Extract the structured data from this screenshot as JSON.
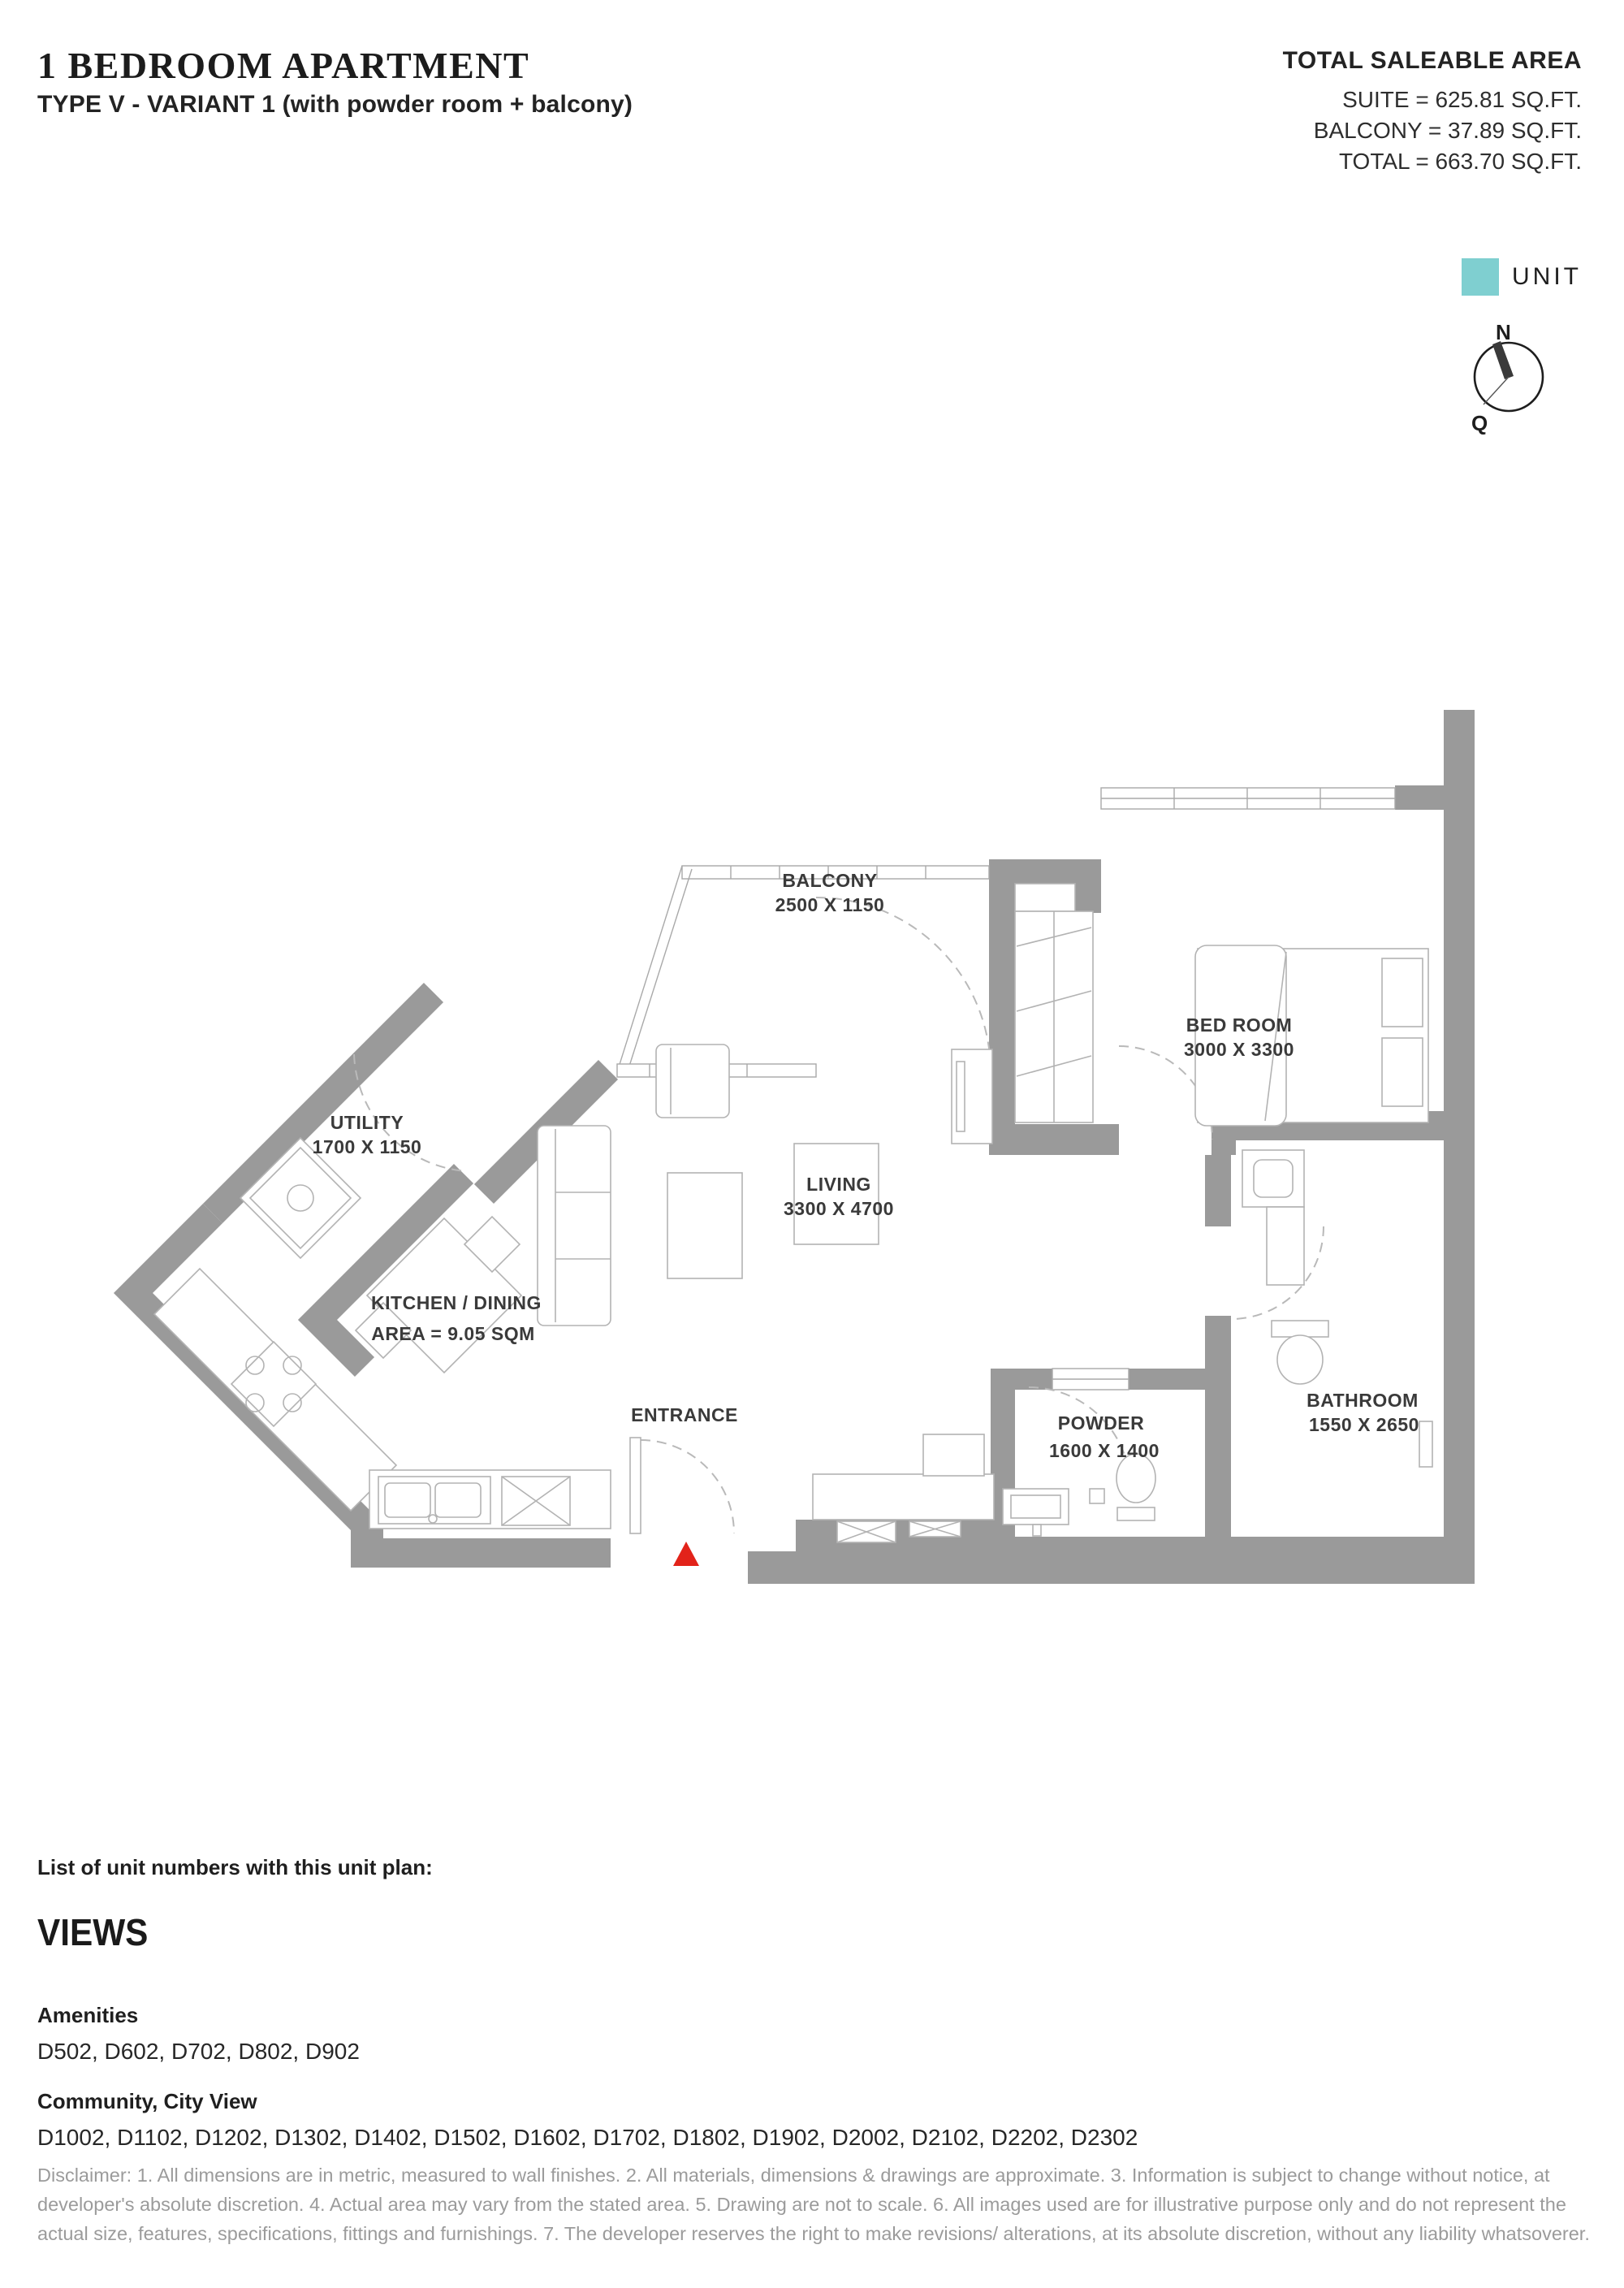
{
  "header": {
    "title": "1 BEDROOM APARTMENT",
    "subtitle": "TYPE V - VARIANT 1 (with powder room + balcony)",
    "area": {
      "heading": "TOTAL SALEABLE AREA",
      "suite": "SUITE =  625.81 SQ.FT.",
      "balcony": "BALCONY = 37.89 SQ.FT.",
      "total": "TOTAL = 663.70 SQ.FT."
    }
  },
  "legend": {
    "unit_label": "UNIT",
    "unit_color": "#7fcfd0"
  },
  "compass": {
    "north_label": "N",
    "q_label": "Q"
  },
  "plan": {
    "wall_color": "#9a9a9a",
    "entrance_marker_color": "#e2231a",
    "balcony": {
      "name": "BALCONY",
      "dim": "2500 X 1150"
    },
    "bedroom": {
      "name": "BED ROOM",
      "dim": "3000 X 3300"
    },
    "utility": {
      "name": "UTILITY",
      "dim": "1700 X 1150"
    },
    "living": {
      "name": "LIVING",
      "dim": "3300 X 4700"
    },
    "kitchen": {
      "name": "KITCHEN / DINING",
      "dim": "AREA = 9.05 SQM"
    },
    "entrance": {
      "name": "ENTRANCE"
    },
    "powder": {
      "name": "POWDER",
      "dim": "1600 X 1400"
    },
    "bathroom": {
      "name": "BATHROOM",
      "dim": "1550 X 2650"
    }
  },
  "footer": {
    "list_heading": "List of unit numbers with this unit plan:",
    "views_heading": "VIEWS",
    "sections": [
      {
        "title": "Amenities",
        "units": "D502, D602, D702, D802, D902"
      },
      {
        "title": "Community, City View",
        "units": "D1002, D1102, D1202, D1302, D1402, D1502, D1602, D1702, D1802, D1902, D2002, D2102, D2202, D2302"
      }
    ],
    "disclaimer": "Disclaimer: 1. All dimensions are in metric, measured to wall finishes. 2. All materials, dimensions & drawings are approximate. 3. Information is subject to change without notice, at developer's absolute discretion. 4. Actual area may vary from the stated area. 5. Drawing are not to scale. 6. All images used are for illustrative purpose only and do not represent the actual size, features, specifications, fittings and furnishings. 7. The developer reserves the right to make revisions/ alterations, at its absolute discretion, without any liability whatsoverer."
  }
}
